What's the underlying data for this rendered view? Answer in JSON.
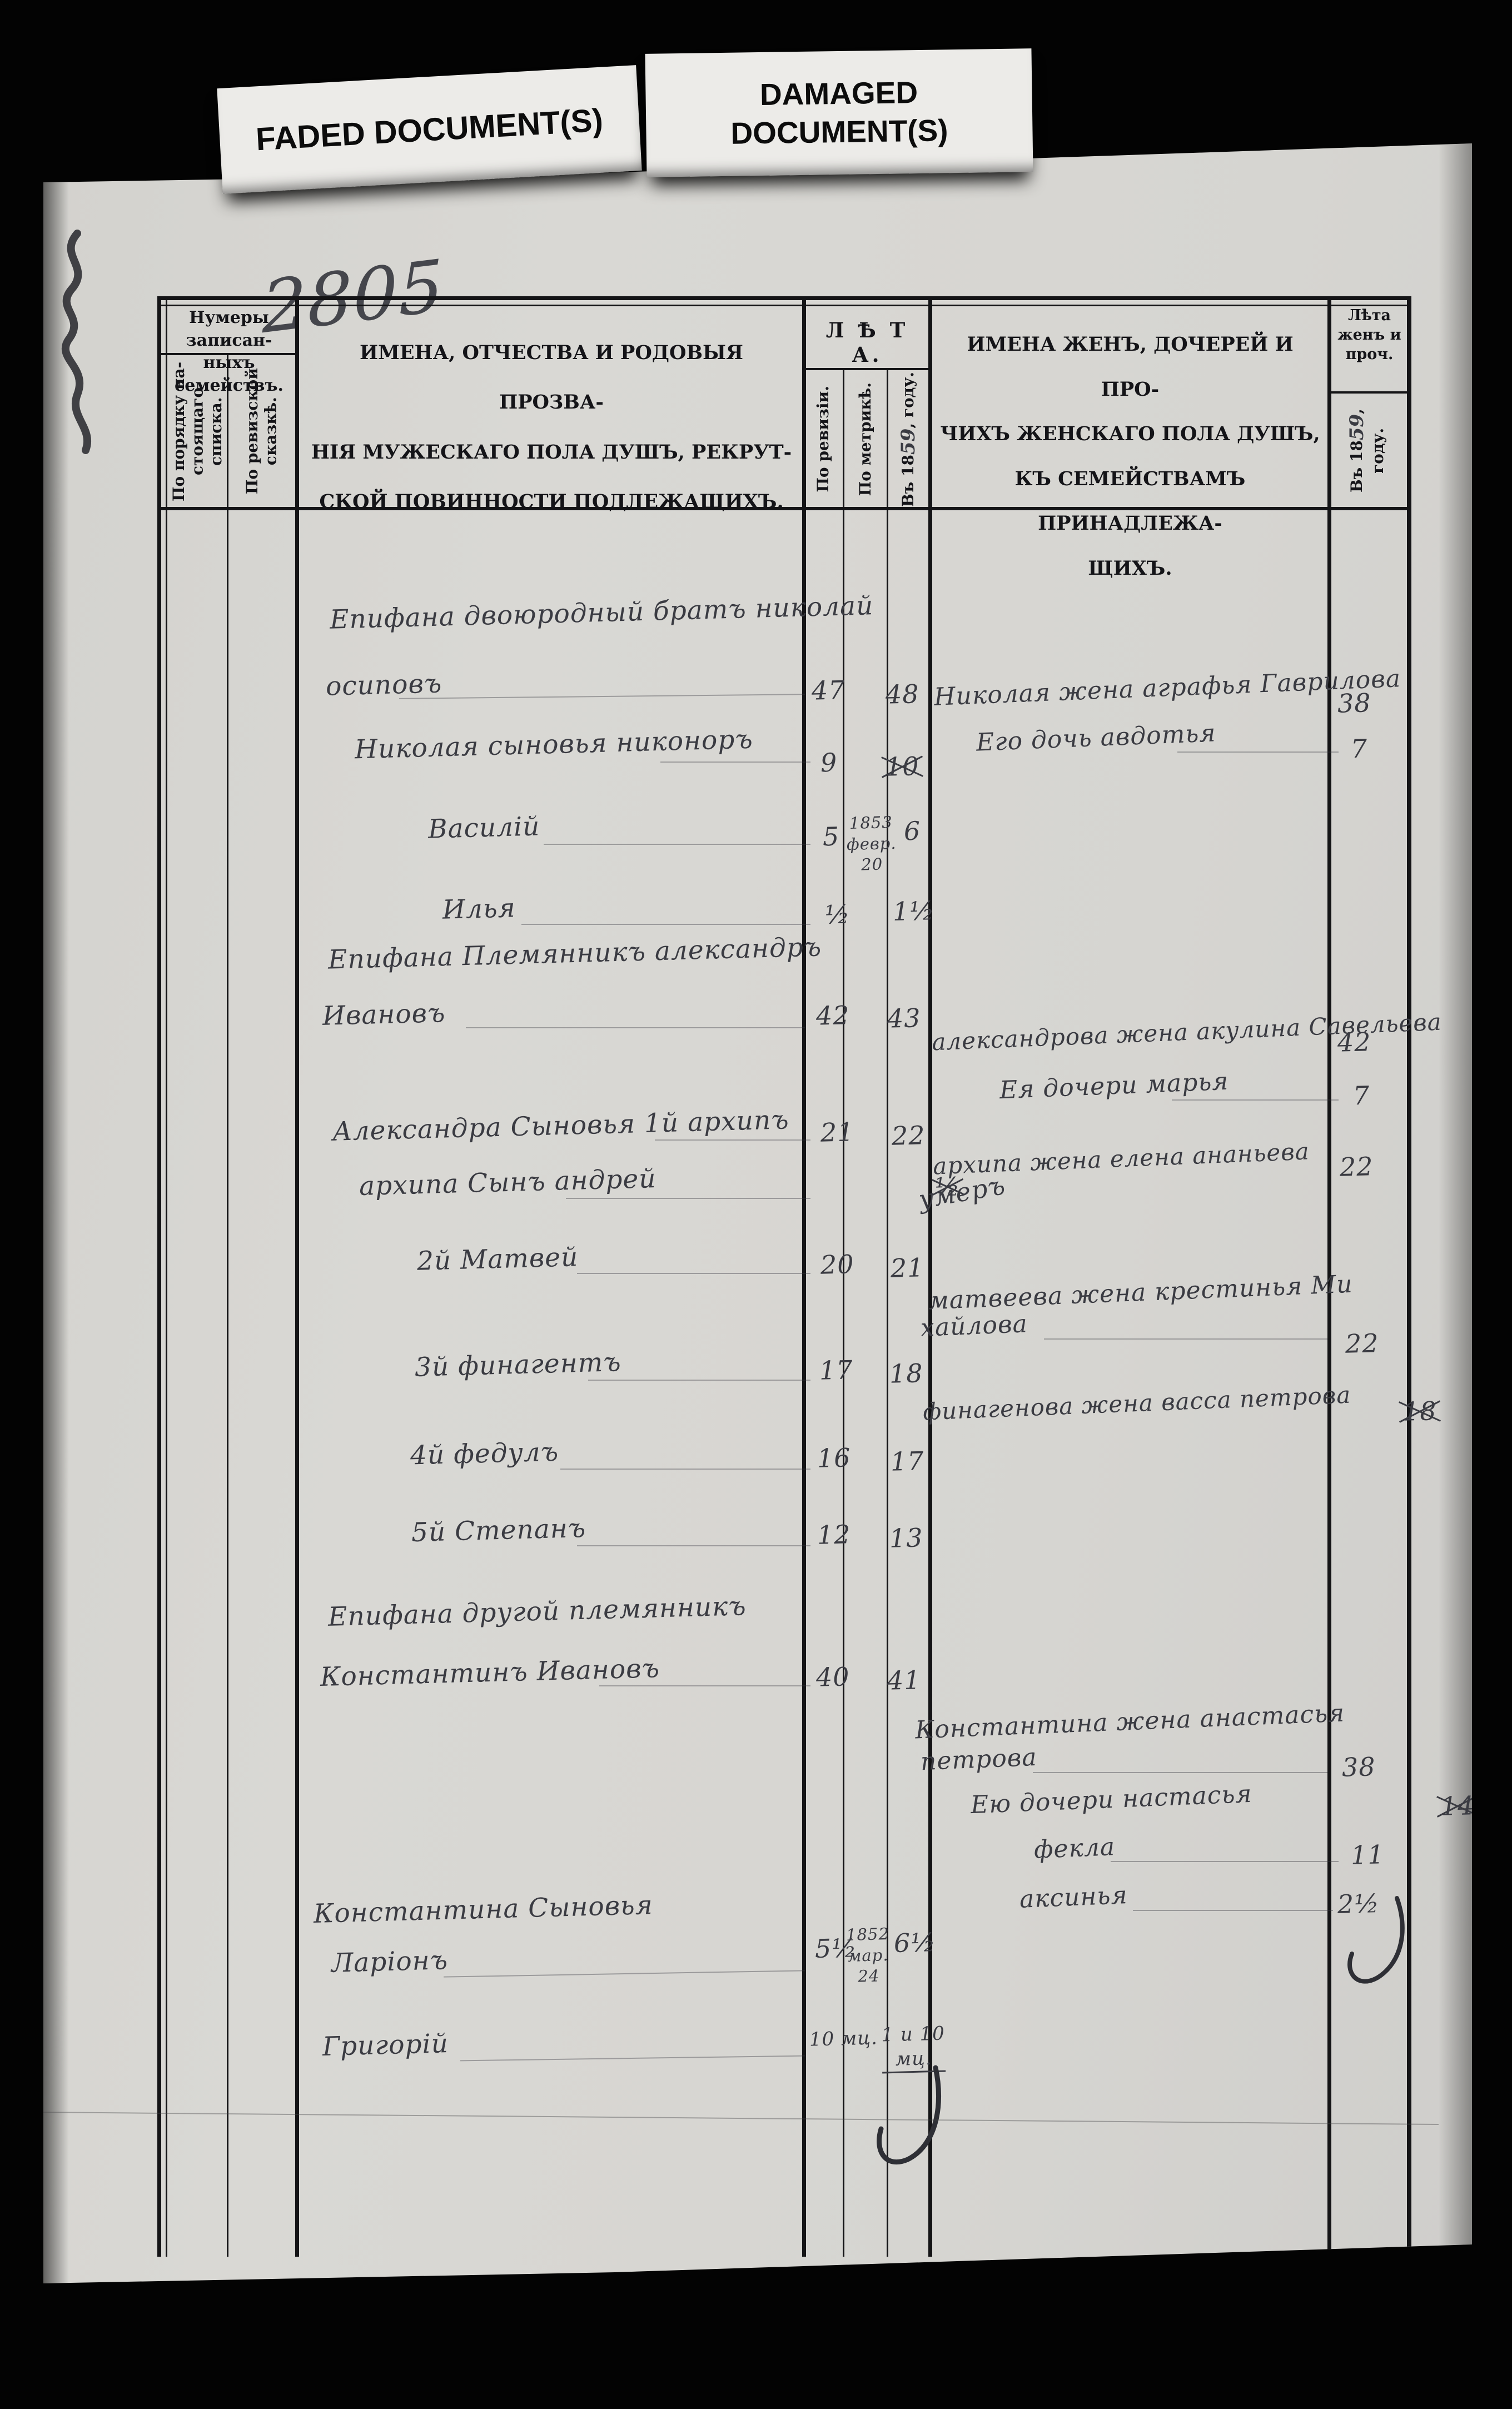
{
  "labels": {
    "faded": "FADED DOCUMENT(S)",
    "damaged": "DAMAGED\nDOCUMENT(S)"
  },
  "margin": {
    "page_number": "2805"
  },
  "header": {
    "family_numbers": "Нумеры записан-\nныхъ семействъ.",
    "by_current_list": "По порядку на-\nстоящаго списка.",
    "by_revision_tale": "По ревизской\nсказкѣ.",
    "male_title": "ИМЕНА, ОТЧЕСТВА И РОДОВЫЯ ПРОЗВА-\nНІЯ МУЖЕСКАГО ПОЛА ДУШЪ, РЕКРУТ-\nСКОЙ ПОВИННОСТИ ПОДЛЕЖАЩИХЪ.",
    "years_title": "Л Ѣ Т А.",
    "by_revision": "По ревизіи.",
    "by_metrics": "По метрикѣ.",
    "in_year_prefix": "Въ 18",
    "in_year_hw": "59",
    "in_year_suffix": ", году.",
    "female_title": "ИМЕНА ЖЕНЪ, ДОЧЕРЕЙ И ПРО-\nЧИХЪ ЖЕНСКАГО ПОЛА ДУШЪ,\nКЪ СЕМЕЙСТВАМЪ ПРИНАДЛЕЖА-\nЩИХЪ.",
    "female_years": "Лѣта\nженъ и\nпроч."
  },
  "male": [
    {
      "name": "Епифана двоюродный братъ николай",
      "name2": "осиповъ",
      "age_revision": "47",
      "age_now": "48"
    },
    {
      "name": "Николая сыновья никоноръ",
      "age_revision": "9",
      "age_now": "10"
    },
    {
      "name": "Василій",
      "age_revision": "5",
      "age_metric": "1853\nфевр.\n20",
      "age_now": "6"
    },
    {
      "name": "Илья",
      "age_revision": "½",
      "age_now": "1½"
    },
    {
      "name": "Епифана Племянникъ александръ",
      "name2": "Ивановъ",
      "age_revision": "42",
      "age_now": "43"
    },
    {
      "name": "Александра Сыновья 1й архипъ",
      "age_revision": "21",
      "age_now": "22"
    },
    {
      "name": "архипа Сынъ андрей",
      "age_now": "½"
    },
    {
      "name": "2й Матвей",
      "age_revision": "20",
      "age_now": "21"
    },
    {
      "name": "3й финагентъ",
      "age_revision": "17",
      "age_now": "18"
    },
    {
      "name": "4й федулъ",
      "age_revision": "16",
      "age_now": "17"
    },
    {
      "name": "5й Степанъ",
      "age_revision": "12",
      "age_now": "13"
    },
    {
      "name": "Епифана другой племянникъ",
      "name2": "Константинъ Ивановъ",
      "age_revision": "40",
      "age_now": "41"
    },
    {
      "name": "Константина Сыновья"
    },
    {
      "name": "Ларіонъ",
      "age_revision": "5½",
      "age_metric": "1852\nмар.\n24",
      "age_now": "6½"
    },
    {
      "name": "Григорій",
      "age_revision": "10 мц.",
      "age_now": "1 и 10\nмц."
    }
  ],
  "female": [
    {
      "name": "Николая жена аграфья Гаврилова",
      "age": "38"
    },
    {
      "name": "Его дочь авдотья",
      "age": "7"
    },
    {
      "name": "александрова жена акулина Савельева",
      "age": "42"
    },
    {
      "name": "Ея дочери марья",
      "age": "7"
    },
    {
      "name": "архипа жена елена ананьева",
      "age": "22"
    },
    {
      "name": "умеръ"
    },
    {
      "name": "матвеева жена крестинья Ми",
      "name2": "хайлова",
      "age": "22"
    },
    {
      "name": "финагенова жена васса петрова",
      "age": "18"
    },
    {
      "name": "Константина жена анастасья",
      "name2": "петрова",
      "age": "38"
    },
    {
      "name": "Ею дочери настасья",
      "age": "14"
    },
    {
      "name": "фекла",
      "age": "11"
    },
    {
      "name": "аксинья",
      "age": "2½"
    }
  ]
}
